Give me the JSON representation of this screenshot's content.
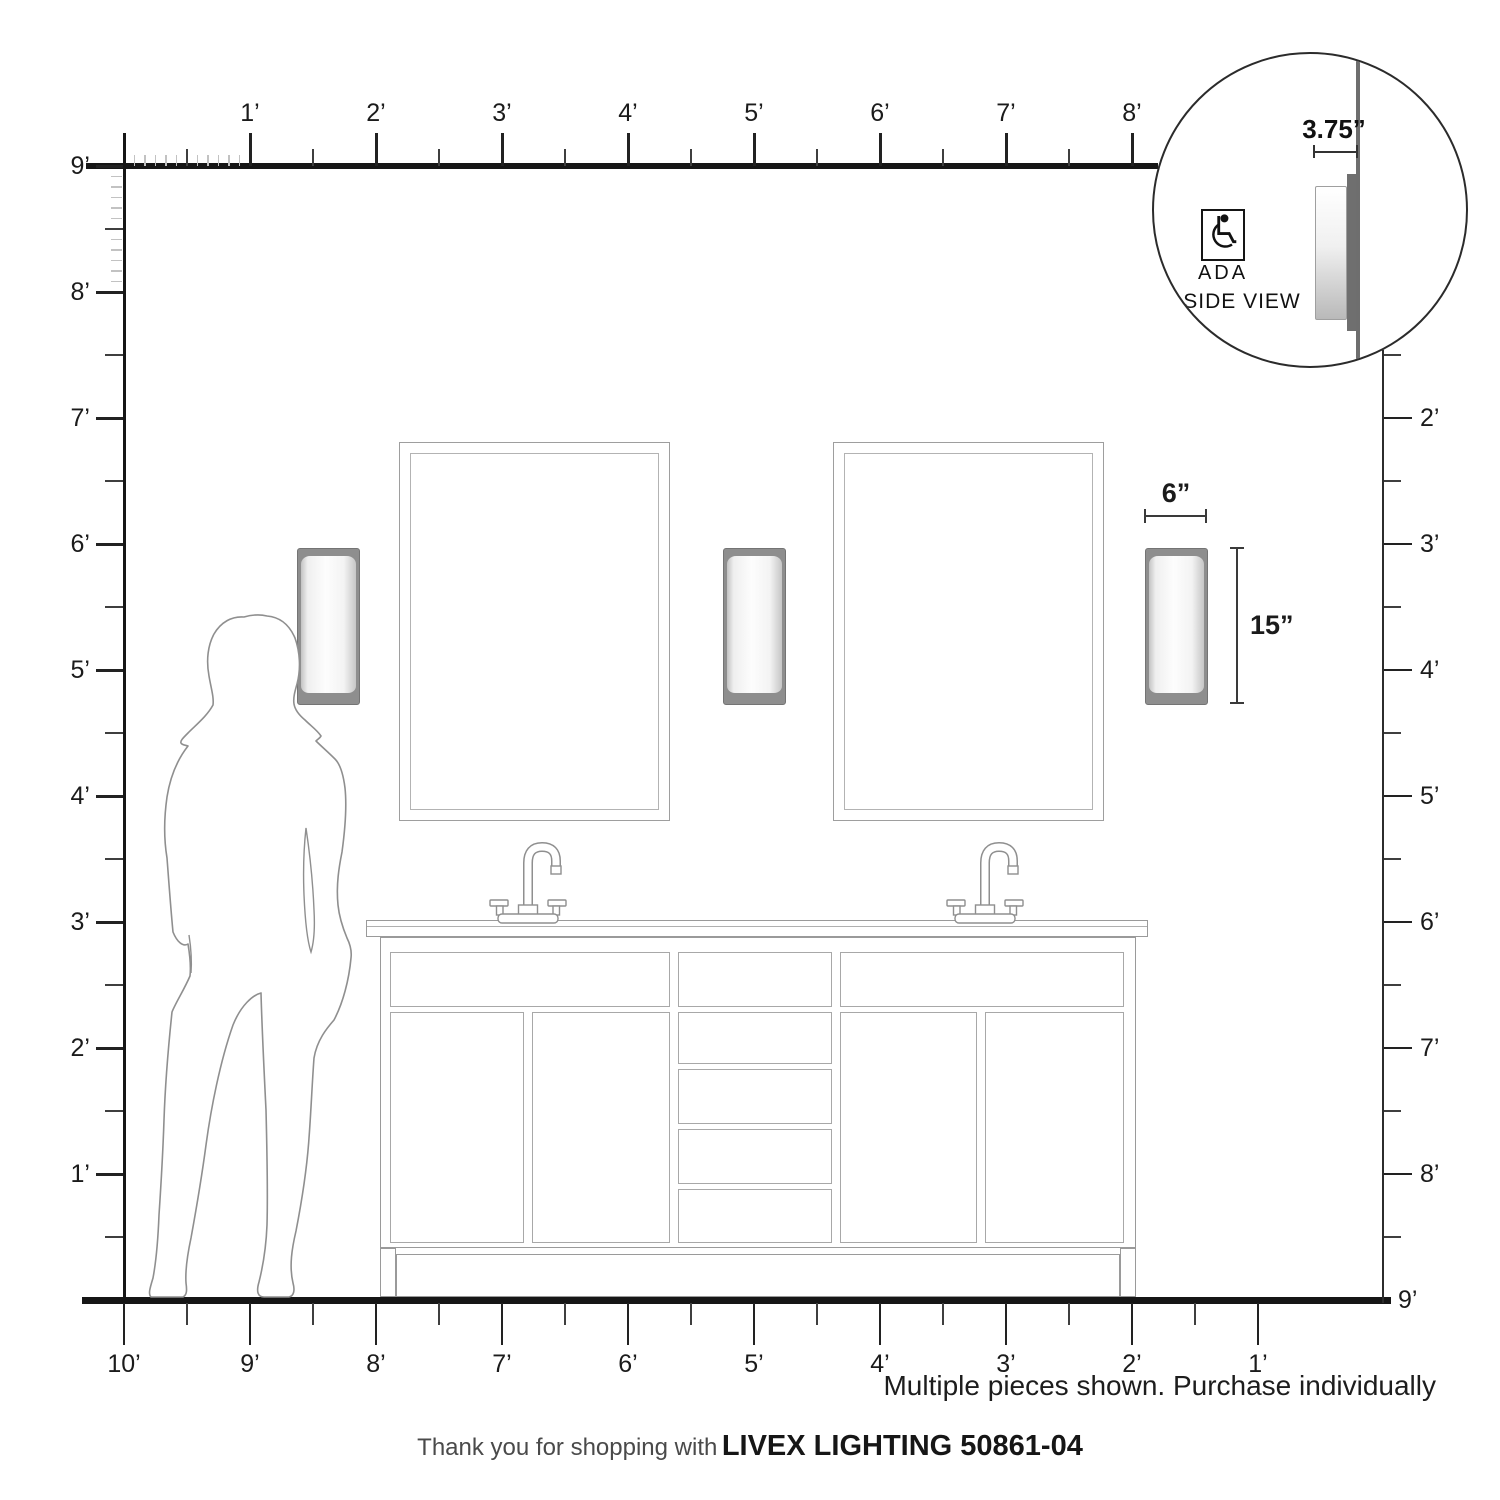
{
  "rulers": {
    "top": {
      "labels": [
        "1’",
        "2’",
        "3’",
        "4’",
        "5’",
        "6’",
        "7’",
        "8’"
      ]
    },
    "left": {
      "labels": [
        "9’",
        "8’",
        "7’",
        "6’",
        "5’",
        "4’",
        "3’",
        "2’",
        "1’"
      ]
    },
    "right": {
      "labels": [
        "2’",
        "3’",
        "4’",
        "5’",
        "6’",
        "7’",
        "8’",
        "9’"
      ]
    },
    "bottom": {
      "labels": [
        "10’",
        "9’",
        "8’",
        "7’",
        "6’",
        "5’",
        "4’",
        "3’",
        "2’",
        "1’"
      ]
    }
  },
  "annotations": {
    "sconce_width": "6”",
    "sconce_height": "15”",
    "sconce_depth": "3.75”"
  },
  "inset": {
    "ada": "ADA",
    "side_view": "SIDE VIEW",
    "wheelchair_icon": "wheelchair-symbol"
  },
  "notes": {
    "disclaimer": "Multiple pieces shown. Purchase individually"
  },
  "footer": {
    "thanks_text": "Thank you for shopping with",
    "product_code": "LIVEX LIGHTING 50861-04"
  },
  "colors": {
    "ruler_line": "#161616",
    "outline_gray": "#9a9a9a",
    "sconce_plate_gray": "#8e8e8e",
    "inch_tick_gray": "#c2c2c2"
  }
}
